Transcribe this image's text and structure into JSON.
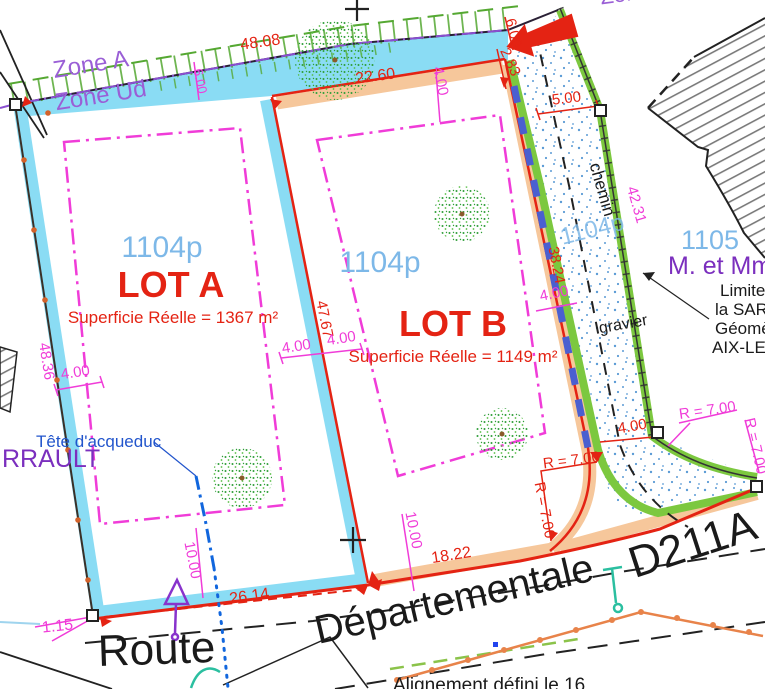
{
  "plan": {
    "zones": {
      "zone_a": "Zone A",
      "zone_ud": "Zone Ud",
      "zone_clipped": "Zone"
    },
    "lot_a": {
      "parcel": "1104p",
      "name": "LOT A",
      "area": "Superficie Réelle = 1367 m²"
    },
    "lot_b": {
      "parcel": "1104p",
      "name": "LOT B",
      "area": "Superficie Réelle = 1149 m²"
    },
    "chemin_strip": {
      "parcel": "1104p",
      "path_label": "chemin",
      "surface_label": "gravier"
    },
    "neighbor": {
      "parcel": "1105",
      "owner": "M. et Mme",
      "note1": "Limite",
      "note2": "la SARL",
      "note3": "Géomè",
      "note4": "AIX-LES"
    },
    "west_owner": "RRAULT",
    "annotations": {
      "aqueduct": "Tête d'acqueduc",
      "alignment": "Alignement défini le 16"
    },
    "road": {
      "name_line1": "Route",
      "name_line2": "Départementale",
      "ref": "D211A"
    },
    "dims": {
      "l48_08": "48.08",
      "l22_60": "22.60",
      "l2_83": "2.83",
      "l6_00": "6.00",
      "l5_00": "5.00",
      "l4_00": "4.00",
      "l48_36": "48.36",
      "l47_67": "47.67",
      "l38_24": "38.24",
      "l42_31": "42.31",
      "l10_00": "10.00",
      "l18_22": "18.22",
      "l26_14": "26.14",
      "l1_15": "1.15",
      "r7_00": "R = 7.00"
    },
    "colors": {
      "boundary_red": "#e42313",
      "dim_magenta": "#f03cd8",
      "band_cyan": "#8adcf4",
      "band_peach": "#f6c79b",
      "band_green": "#7cc83f",
      "zone_purple": "#9a5fd6",
      "parcel_blue": "#7db8e8",
      "pipe_blue": "#4a5fd0",
      "fence_orange": "#e8834a",
      "utility_teal": "#2bbfa0",
      "water_blue": "#2255cc"
    }
  }
}
